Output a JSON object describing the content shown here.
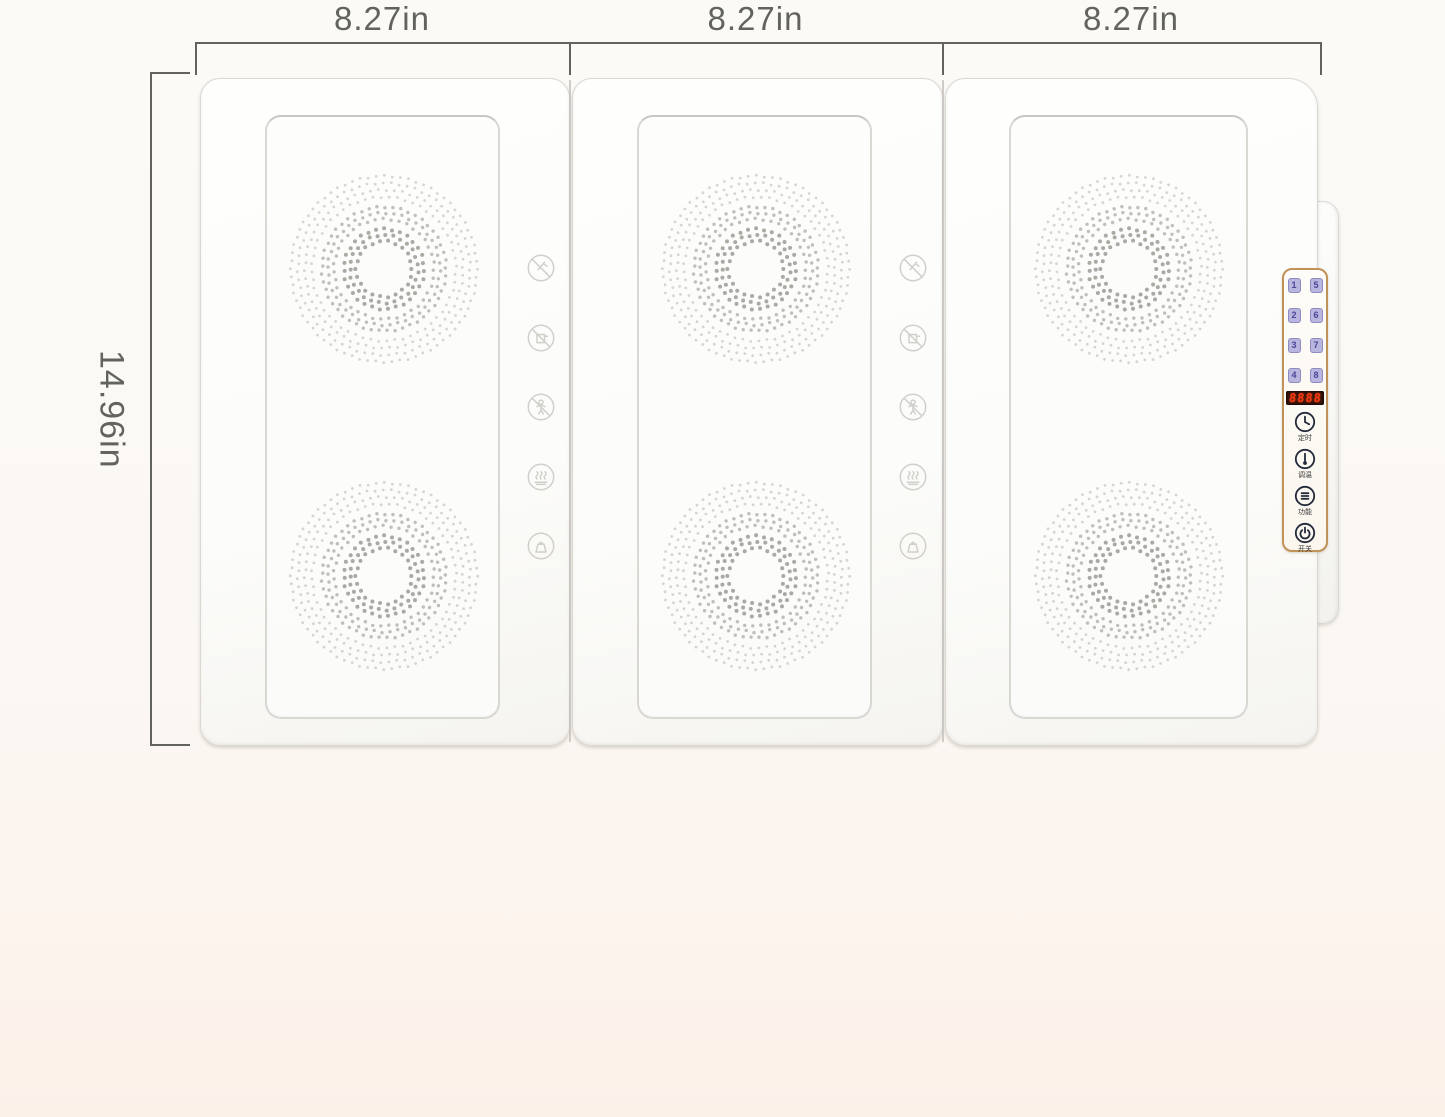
{
  "dimensions": {
    "widths": [
      {
        "label": "8.27in"
      },
      {
        "label": "8.27in"
      },
      {
        "label": "8.27in"
      }
    ],
    "height_label": "14.96in"
  },
  "panels": {
    "count": 3,
    "burners_per_panel": 2,
    "safety_icons": [
      {
        "name": "no-knife-icon"
      },
      {
        "name": "no-pot-icon"
      },
      {
        "name": "no-touch-icon"
      },
      {
        "name": "hot-surface-icon"
      },
      {
        "name": "no-heavy-load-icon"
      }
    ]
  },
  "control_panel": {
    "zone_buttons": [
      "1",
      "5",
      "2",
      "6",
      "3",
      "7",
      "4",
      "8"
    ],
    "led_display": "8888",
    "buttons": [
      {
        "icon": "clock-icon",
        "label": "定时"
      },
      {
        "icon": "thermometer-icon",
        "label": "调温"
      },
      {
        "icon": "function-menu-icon",
        "label": "功能"
      },
      {
        "icon": "power-icon",
        "label": "开关"
      }
    ]
  },
  "colors": {
    "accent_gold": "#c19257",
    "led_text": "#f23a10",
    "led_bg": "#2f130b",
    "zone_button_bg": "#b8b5de",
    "zone_button_text": "#4b4798",
    "control_icon": "#232a3c",
    "dimension": "#63635e",
    "dot": "#8f8d86",
    "faint_icon": "#c9c8c2",
    "seam": "#c4c1bb",
    "background_top": "#fbfaf7",
    "background_bottom": "#fcf1e9"
  }
}
